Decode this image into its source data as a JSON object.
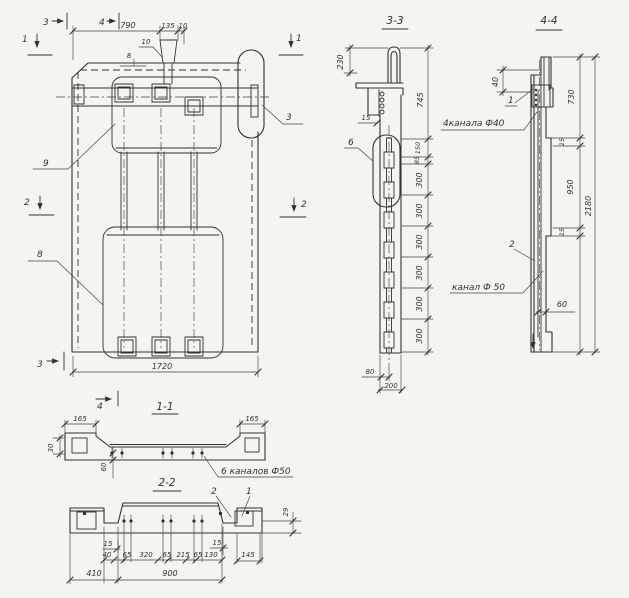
{
  "sheet": {
    "paper_color": "#f5f4f0",
    "ink_color": "#35322d"
  },
  "main_view": {
    "cut_1": "1",
    "cut_2": "2",
    "cut_3": "3",
    "cut_4": "4",
    "dim_790": "790",
    "dim_135": "135",
    "dim_10": "10",
    "leader_10": "10",
    "dim_8": "8",
    "dim_1720": "1720",
    "callout_9": "9",
    "callout_8": "8",
    "callout_3": "3"
  },
  "section_3_3": {
    "title": "3-3",
    "dim_230": "230",
    "dim_745": "745",
    "dim_150": "150",
    "dim_85": "85",
    "dim_300": "300",
    "dim_15": "15",
    "dim_80": "80",
    "dim_200": "200",
    "callout_6": "6"
  },
  "section_4_4": {
    "title": "4-4",
    "dim_40": "40",
    "dim_730": "730",
    "dim_15": "15",
    "dim_950": "950",
    "dim_2180": "2180",
    "dim_60": "60",
    "callout_1": "1",
    "callout_2": "2",
    "label_channels_40": "4канала Ф40",
    "label_channel_50": "канал Ф 50"
  },
  "section_1_1": {
    "title": "1-1",
    "dim_165_left": "165",
    "dim_165_right": "165",
    "dim_30": "30",
    "dim_60": "60",
    "label_channels_50": "6 каналов Ф50"
  },
  "section_2_2": {
    "title": "2-2",
    "callout_1": "1",
    "callout_2": "2",
    "dim_15_left": "15",
    "dim_15_right": "15",
    "dim_29": "29",
    "row": [
      "40",
      "65",
      "320",
      "65",
      "215",
      "65",
      "130"
    ],
    "dim_145": "145",
    "dim_410": "410",
    "dim_900": "900"
  }
}
